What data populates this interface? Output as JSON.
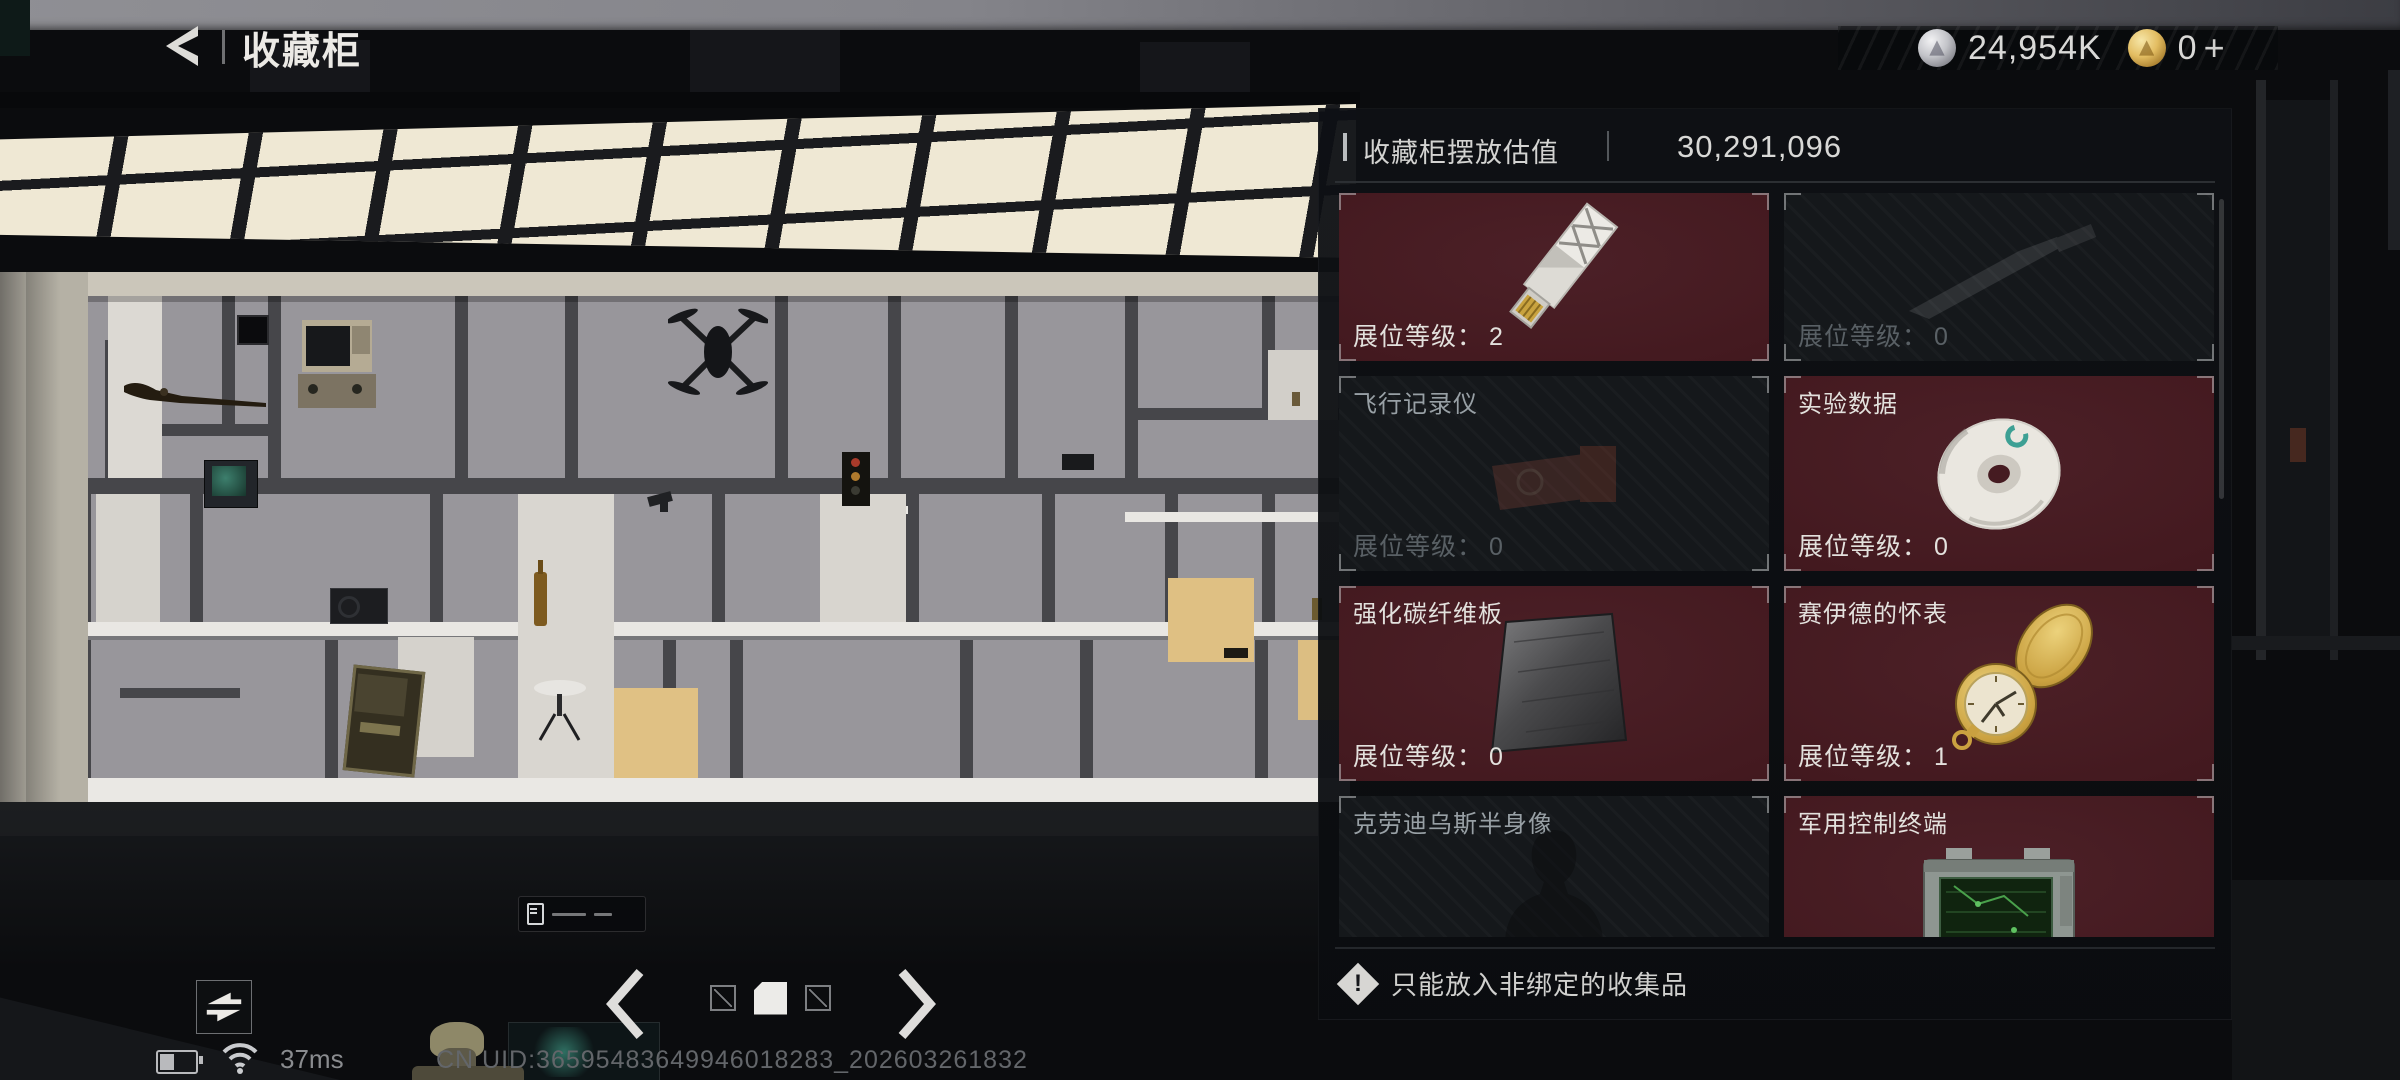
{
  "header": {
    "title": "收藏柜"
  },
  "currencies": {
    "silver_amount": "24,954K",
    "gold_amount": "0",
    "gold_plus": "+"
  },
  "panel": {
    "title": "收藏柜摆放估值",
    "value": "30,291,096",
    "level_label": "展位等级：",
    "warning": "只能放入非绑定的收集品",
    "items": [
      {
        "name": "",
        "level": "2",
        "filled": true,
        "image": "usb-drive"
      },
      {
        "name": "",
        "level": "0",
        "filled": false,
        "image": "knife-ghost"
      },
      {
        "name": "飞行记录仪",
        "level": "0",
        "filled": false,
        "image": "flight-recorder-ghost"
      },
      {
        "name": "实验数据",
        "level": "0",
        "filled": true,
        "image": "cd-disc"
      },
      {
        "name": "强化碳纤维板",
        "level": "0",
        "filled": true,
        "image": "carbon-plate"
      },
      {
        "name": "赛伊德的怀表",
        "level": "1",
        "filled": true,
        "image": "pocket-watch"
      },
      {
        "name": "克劳迪乌斯半身像",
        "level": "",
        "filled": false,
        "image": "bust-ghost"
      },
      {
        "name": "军用控制终端",
        "level": "",
        "filled": true,
        "image": "military-terminal"
      }
    ]
  },
  "pagination": {
    "total_pages": 3,
    "active_index": 1
  },
  "status_bar": {
    "ping": "37ms",
    "uid": "CN UID:36595483649946018283_202603261832"
  },
  "icons": {
    "back": "chevron-left",
    "silver_currency": "silver-coin",
    "gold_currency": "gold-coin",
    "estimate_coin": "silver-coin",
    "warning": "exclamation-diamond",
    "view_toggle": "swap-arrows",
    "prev_page": "chevron-left",
    "next_page": "chevron-right",
    "network": "wifi",
    "power": "battery"
  },
  "colors": {
    "card_filled_bg": "#43191f",
    "panel_bg": "#0d0f13",
    "accent_text": "#e3e1dd",
    "dim_text": "#596065",
    "gold": "#d9b45c",
    "silver": "#c6c7cc"
  }
}
